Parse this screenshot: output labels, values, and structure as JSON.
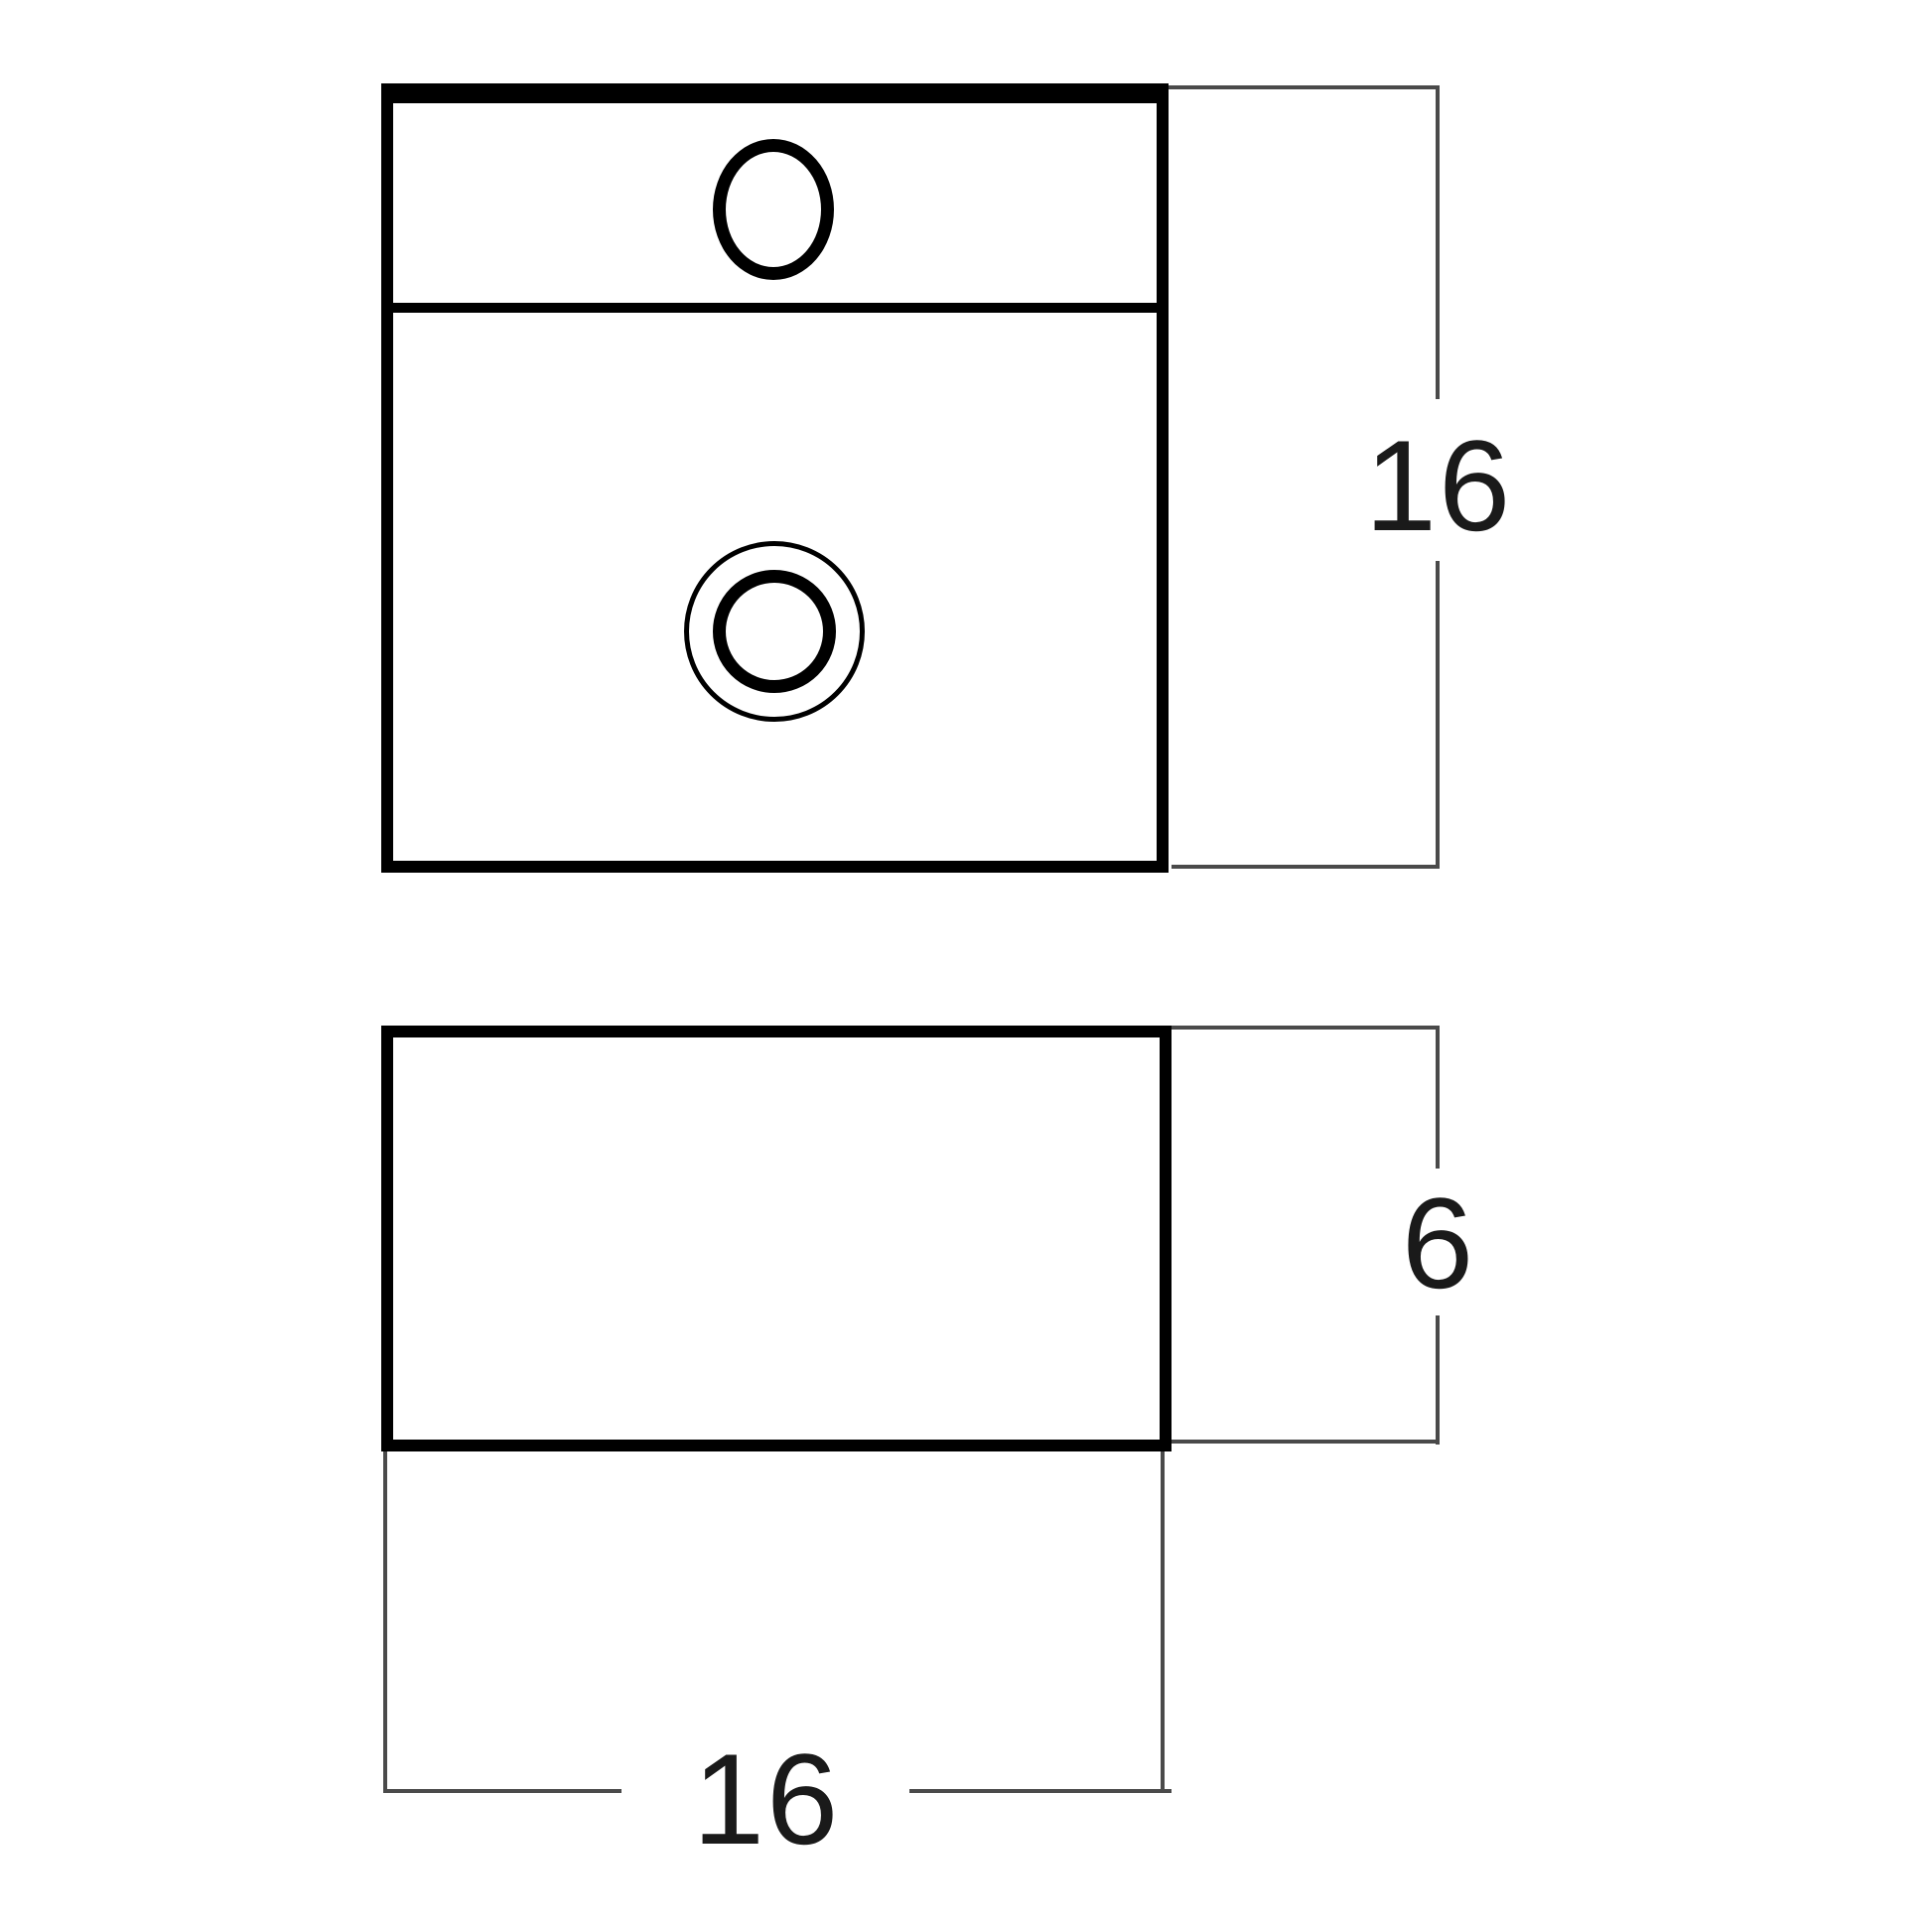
{
  "canvas": {
    "background_color": "#ffffff",
    "outline_color": "#000000",
    "dimension_line_color": "#4a4a4a",
    "label_color": "#1a1a1a"
  },
  "views": {
    "plan": {
      "depth_label": "16"
    },
    "side": {
      "height_label": "6",
      "width_label": "16"
    }
  }
}
